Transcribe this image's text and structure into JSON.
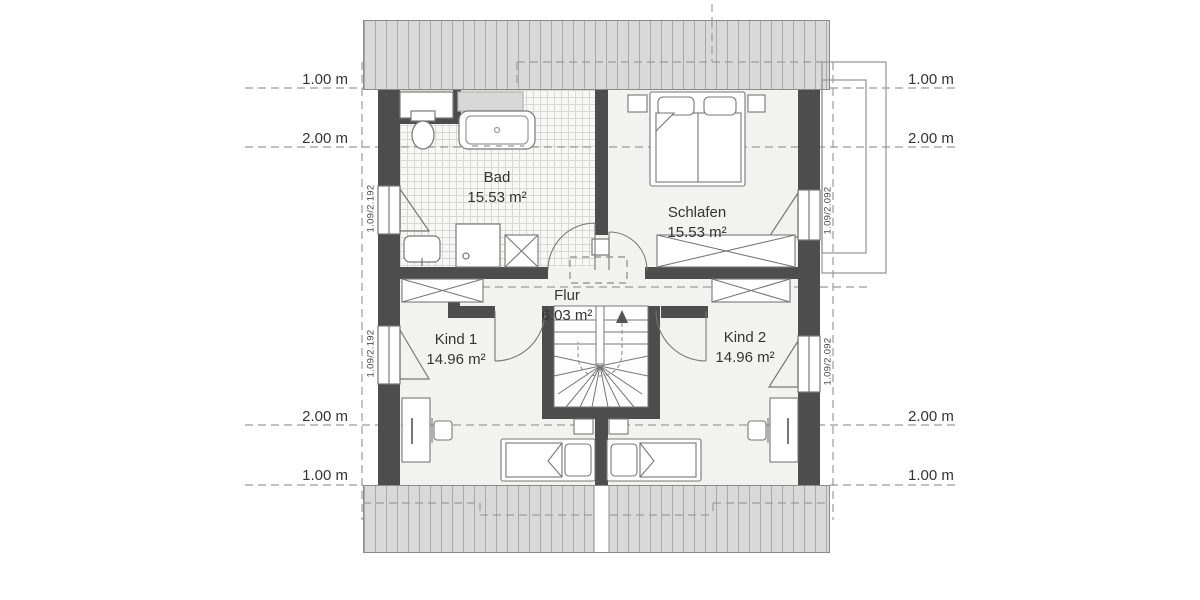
{
  "plan": {
    "rooms": [
      {
        "name": "Bad",
        "area": "15.53 m²"
      },
      {
        "name": "Schlafen",
        "area": "15.53 m²"
      },
      {
        "name": "Flur",
        "area": "6.03 m²"
      },
      {
        "name": "Kind 1",
        "area": "14.96 m²"
      },
      {
        "name": "Kind 2",
        "area": "14.96 m²"
      }
    ],
    "dimension_labels": {
      "top_left": "1.00 m",
      "upper_left": "2.00 m",
      "lower_left": "2.00 m",
      "bottom_left": "1.00 m",
      "top_right": "1.00 m",
      "upper_right": "2.00 m",
      "lower_right": "2.00 m",
      "bottom_right": "1.00 m"
    },
    "window_labels": {
      "left_top": "1.09/2.192",
      "left_bottom": "1.09/2.192",
      "right_top": "1.09/2.092",
      "right_bottom": "1.09/2.092"
    },
    "colors": {
      "wall": "#4d4d4d",
      "roof_fill": "#d9d9d9",
      "roof_stripe": "#a9a9a9",
      "floor": "#f2f2f0",
      "furniture_line": "#777777",
      "dash_line": "#9b9b9b"
    }
  }
}
